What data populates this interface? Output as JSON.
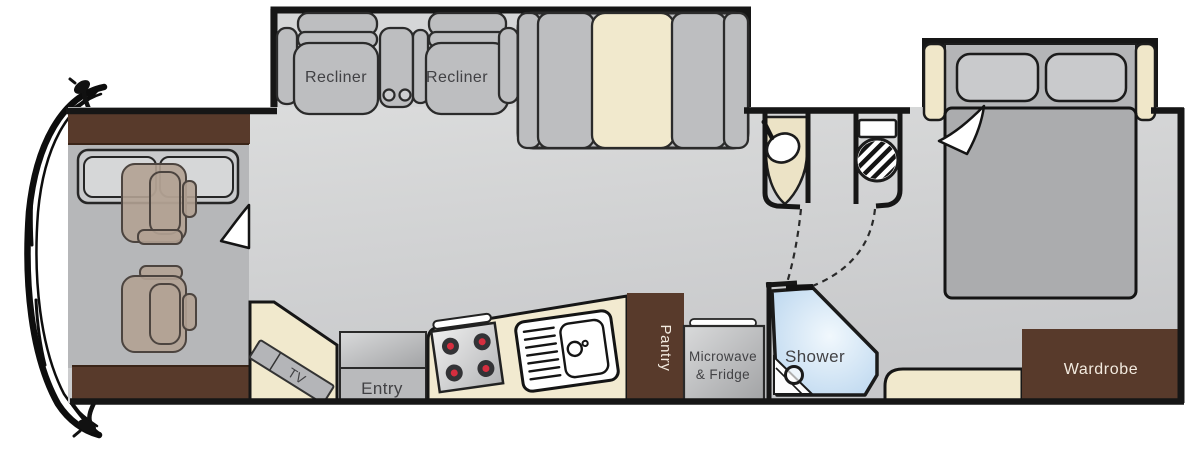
{
  "floorplan": {
    "labels": {
      "recliner_left": "Recliner",
      "recliner_right": "Recliner",
      "tv": "TV",
      "entry": "Entry",
      "pantry": "Pantry",
      "microwave_fridge": [
        "Microwave",
        "& Fridge"
      ],
      "shower": "Shower",
      "wardrobe": "Wardrobe"
    },
    "colors": {
      "wall": "#161616",
      "cabinet_brown": "#583a2b",
      "accent_cream": "#f1e9cd",
      "upholstery_gray": "#bdbec0",
      "floor_gray": "#d6d7d8",
      "cab_floor_gray": "#b6b7b9",
      "seat_tan": "#b2a294",
      "shower_blue": "#bfd9ef",
      "burner_red": "#d62e3f",
      "label_dark": "#414144",
      "label_light": "#f2eadf"
    }
  }
}
